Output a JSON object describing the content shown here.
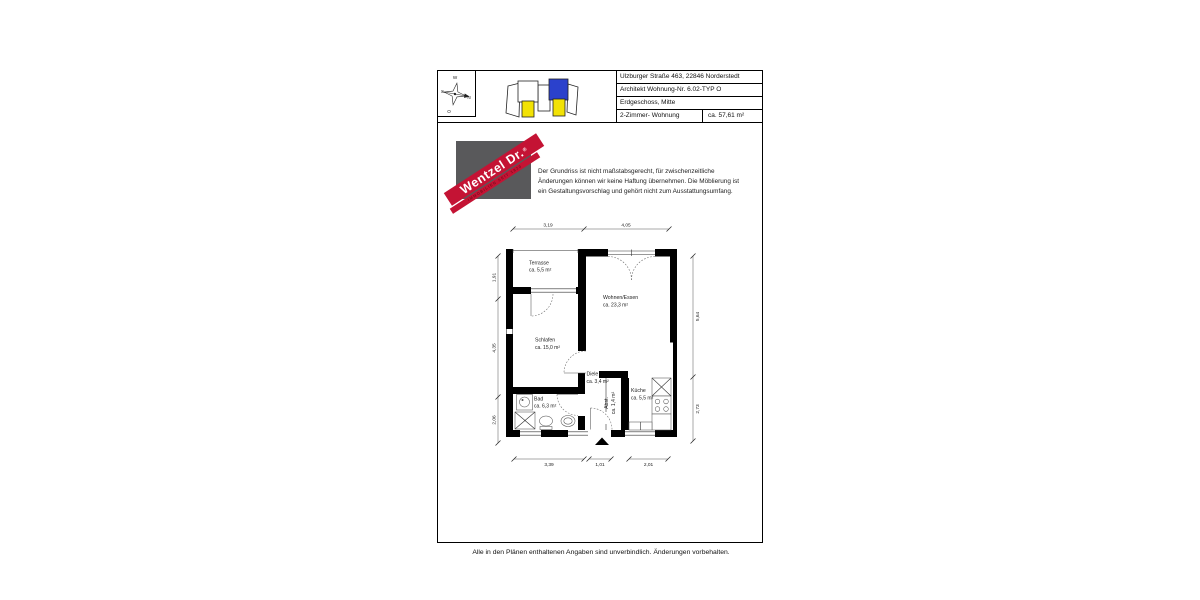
{
  "header": {
    "compass": {
      "w": "W",
      "s": "S.",
      "n": "N",
      "o": "O"
    },
    "table": {
      "rows": [
        "Ulzburger Straße 463, 22846 Norderstedt",
        "Architekt Wohnung-Nr. 6.02-TYP O",
        "Erdgeschoss, Mitte"
      ],
      "type": "2-Zimmer- Wohnung",
      "area": "ca. 57,61 m²"
    },
    "siteplan_colors": {
      "highlight_blue": "#2b41cc",
      "highlight_yellow": "#f2e205"
    }
  },
  "logo": {
    "brand": "Wentzel Dr.",
    "registered": "®",
    "tagline": "IMMOBILIEN SEIT 1820",
    "red": "#c41334",
    "gray": "#59595b"
  },
  "disclaimer": {
    "line1": "Der Grundriss ist nicht maßstabsgerecht, für zwischenzeitliche",
    "line2": "Änderungen können wir keine Haftung übernehmen. Die Möblierung ist",
    "line3": "ein Gestaltungsvorschlag und gehört nicht zum Ausstattungsumfang."
  },
  "floorplan": {
    "rooms": [
      {
        "name": "Terrasse",
        "area": "ca. 5,5 m²"
      },
      {
        "name": "Wohnen/Essen",
        "area": "ca. 23,3 m²"
      },
      {
        "name": "Schlafen",
        "area": "ca. 15,0 m²"
      },
      {
        "name": "Diele",
        "area": "ca. 3,4 m²"
      },
      {
        "name": "Bad",
        "area": "ca. 6,3 m²"
      },
      {
        "name": "Küche",
        "area": "ca. 5,5 m²"
      },
      {
        "name": "Abst.",
        "area": "ca. 1,4 m²"
      }
    ],
    "dims": {
      "top": [
        "3,19",
        "4,05"
      ],
      "left": [
        "1,91",
        "4,35",
        "2,06"
      ],
      "right": [
        "5,64",
        "2,73"
      ],
      "bottom": [
        "3,39",
        "1,01",
        "2,01"
      ]
    }
  },
  "footer": {
    "note": "Alle in den Plänen enthaltenen Angaben sind unverbindlich. Änderungen vorbehalten."
  }
}
